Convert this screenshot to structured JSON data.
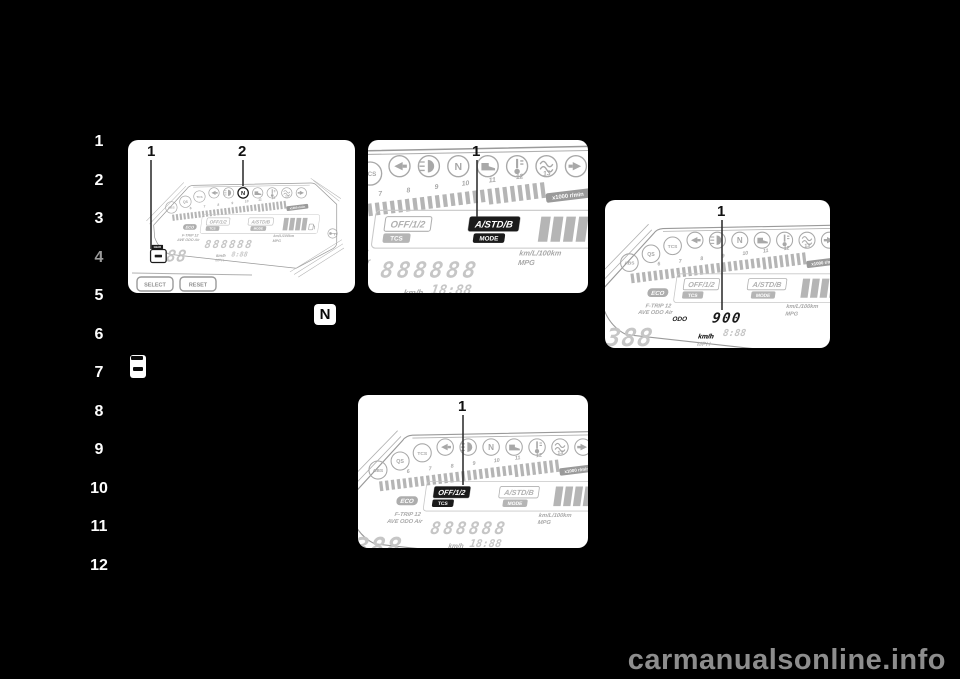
{
  "page": {
    "watermark": "carmanualsonline.info"
  },
  "sidebar": {
    "chapters": [
      "1",
      "2",
      "3",
      "4",
      "5",
      "6",
      "7",
      "8",
      "9",
      "10",
      "11",
      "12"
    ],
    "active_chapter": "4"
  },
  "inline_symbols": {
    "neutral": "N"
  },
  "cluster": {
    "icons": {
      "abs": "ABS",
      "qs": "QS",
      "tcs": "TCS",
      "neutral": "N"
    },
    "tach_ticks": [
      "6",
      "7",
      "8",
      "9",
      "10",
      "11",
      "12",
      "13"
    ],
    "tach_unit": "x1000 r/min",
    "lcd": {
      "eco": "ECO",
      "tcs_levels": "OFF/1/2",
      "tcs_tag": "TCS",
      "drive_modes": "A/STD/B",
      "mode_tag": "MODE",
      "trip_label": "F-TRIP 12",
      "odo_labels": "AVE ODO Air",
      "consumption_units": "km/L/100km",
      "mpg": "MPG",
      "speed_digits": "388",
      "speed_unit_metric": "km/h",
      "speed_unit_imperial": "MPH",
      "gear_tag": "GEAR"
    }
  },
  "panels": {
    "p1": {
      "callout_1": "1",
      "callout_2": "2",
      "digits": "888888",
      "clock": "8:88",
      "select_button": "SELECT",
      "reset_button": "RESET"
    },
    "p2": {
      "callout_1": "1",
      "digits": "888888",
      "clock": "18:88",
      "drive_modes": "A/STD/B",
      "mode_tag": "MODE"
    },
    "p3": {
      "callout_1": "1",
      "odo_label": "ODO",
      "odo_value": "900",
      "clock": "8:88",
      "speed_unit": "km/h"
    },
    "p4": {
      "callout_1": "1",
      "tcs_levels": "OFF/1/2",
      "tcs_tag": "TCS",
      "digits": "888888",
      "clock": "18:88"
    }
  }
}
